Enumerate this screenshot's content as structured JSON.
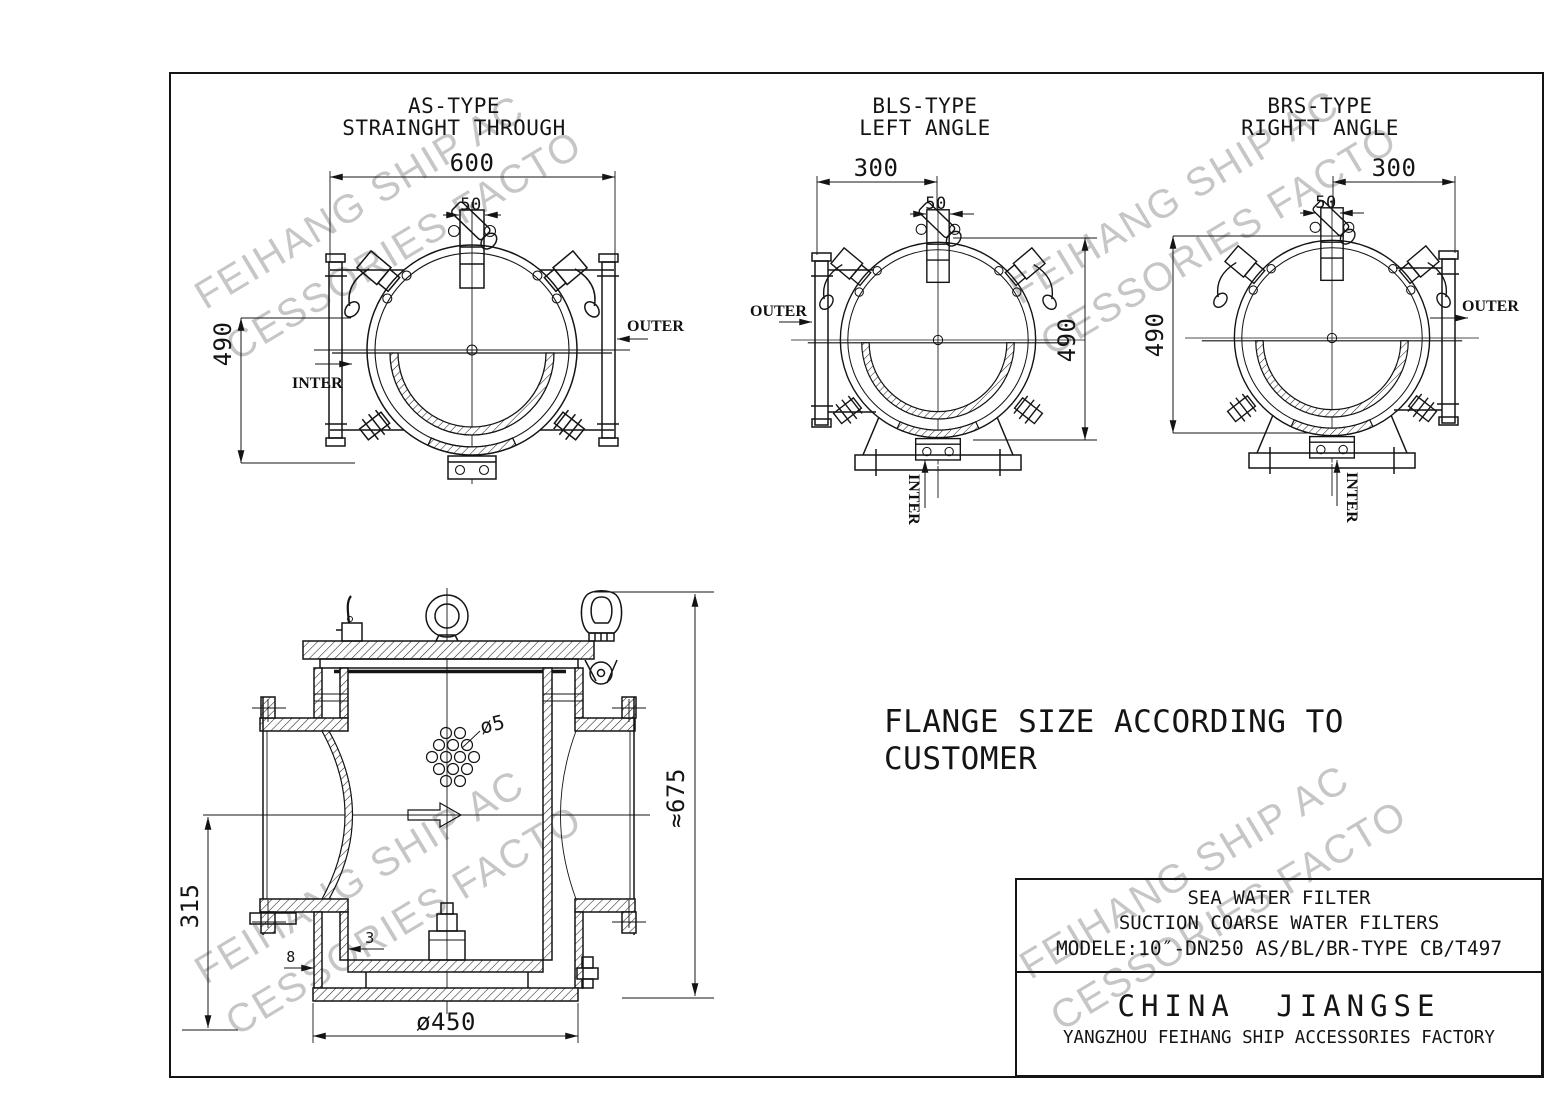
{
  "watermark": {
    "line1": "FEIHANG SHIP AC",
    "line2": "CESSORIES FACTO",
    "color": "#c6c6c6"
  },
  "views": {
    "as": {
      "title1": "AS-TYPE",
      "title2": "STRAINGHT THROUGH",
      "dim_width": "600",
      "dim_neck": "50",
      "dim_height": "490",
      "outer": "OUTER",
      "inter": "INTER"
    },
    "bls": {
      "title1": "BLS-TYPE",
      "title2": "LEFT ANGLE",
      "dim_width": "300",
      "dim_neck": "50",
      "dim_height": "490",
      "outer": "OUTER",
      "inter": "INTER"
    },
    "brs": {
      "title1": "BRS-TYPE",
      "title2": "RIGHTT ANGLE",
      "dim_width": "300",
      "dim_neck": "50",
      "dim_height": "490",
      "outer": "OUTER",
      "inter": "INTER"
    }
  },
  "section": {
    "dim_height": "315",
    "dim_total": "≈675",
    "dim_base_dia": "ø450",
    "dim_hole": "ø5",
    "dim_basket_wall": "3",
    "dim_shell_wall": "8"
  },
  "note": {
    "line1": "FLANGE SIZE ACCORDING TO",
    "line2": "CUSTOMER"
  },
  "title_block": {
    "product": "SEA WATER FILTER",
    "subtitle": "SUCTION COARSE WATER FILTERS",
    "model": "MODELE:10″-DN250  AS/BL/BR-TYPE CB/T497",
    "company_region": "CHINA JIANGSE",
    "company_name": "YANGZHOU FEIHANG SHIP ACCESSORIES FACTORY"
  }
}
